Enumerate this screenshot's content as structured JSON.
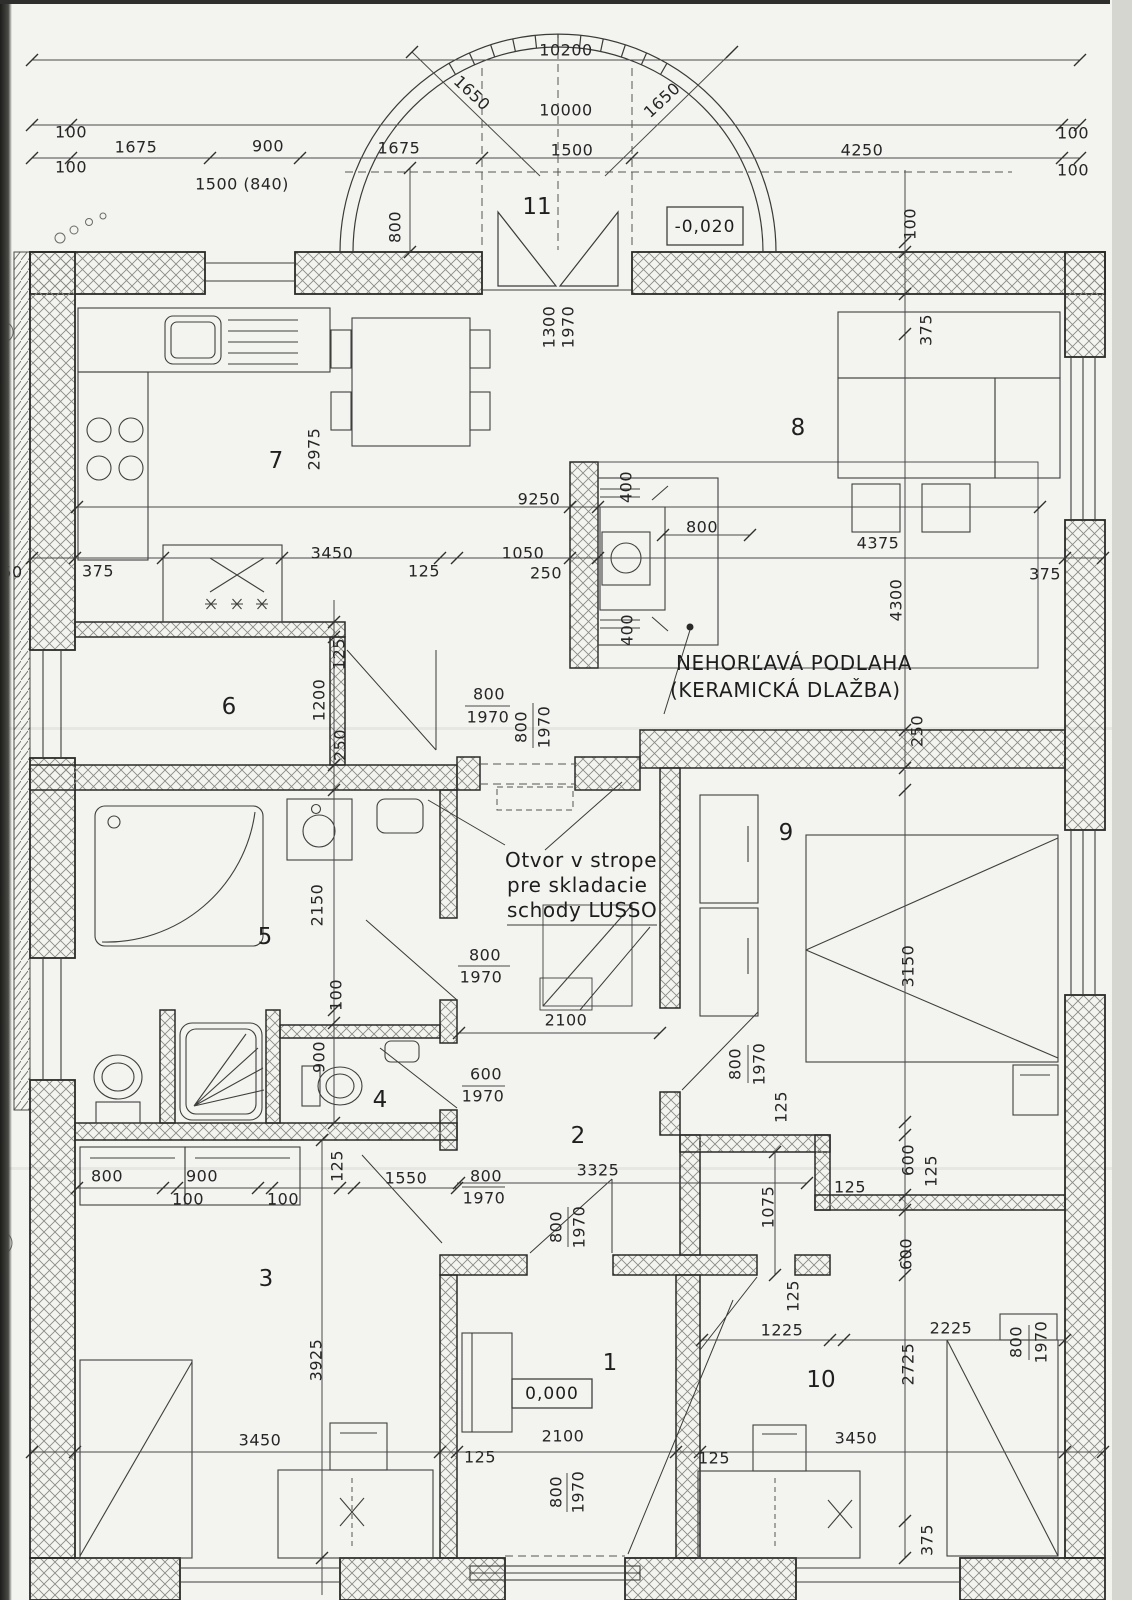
{
  "document": {
    "kind": "scanned architectural floor plan",
    "language": "Slovak"
  },
  "annotations": {
    "floor_note_1": "NEHORĽAVÁ PODLAHA",
    "floor_note_2": "(KERAMICKÁ DLAŽBA)",
    "ceiling_note_1": "Otvor v strope",
    "ceiling_note_2": "pre skladacie",
    "ceiling_note_3": "schody LUSSO"
  },
  "levels": {
    "terrace": "-0,020",
    "interior": "0,000"
  },
  "rooms": [
    {
      "number": "1"
    },
    {
      "number": "2"
    },
    {
      "number": "3"
    },
    {
      "number": "4"
    },
    {
      "number": "5"
    },
    {
      "number": "6"
    },
    {
      "number": "7"
    },
    {
      "number": "8"
    },
    {
      "number": "9"
    },
    {
      "number": "10"
    },
    {
      "number": "11"
    }
  ],
  "dims": [
    "10200",
    "1650",
    "1650",
    "10000",
    "100",
    "100",
    "1675",
    "900",
    "1675",
    "1500",
    "4250",
    "100",
    "100",
    "1500 (840)",
    "800",
    "100",
    "1300",
    "1970",
    "375",
    "2975",
    "9250",
    "400",
    "800",
    "4375",
    "50",
    "375",
    "3450",
    "125",
    "1050",
    "250",
    "375",
    "4300",
    "400",
    "125",
    "1200",
    "250",
    "800",
    "1970",
    "800",
    "1970",
    "250",
    "2150",
    "800",
    "1970",
    "3150",
    "100",
    "900",
    "2100",
    "800",
    "1970",
    "600",
    "1970",
    "125",
    "3325",
    "600",
    "125",
    "800",
    "900",
    "100",
    "100",
    "125",
    "1550",
    "800",
    "1970",
    "800",
    "1970",
    "1075",
    "125",
    "600",
    "125",
    "1225",
    "2225",
    "800",
    "1970",
    "2725",
    "3925",
    "3450",
    "2100",
    "3450",
    "125",
    "125",
    "800",
    "1970",
    "375"
  ]
}
